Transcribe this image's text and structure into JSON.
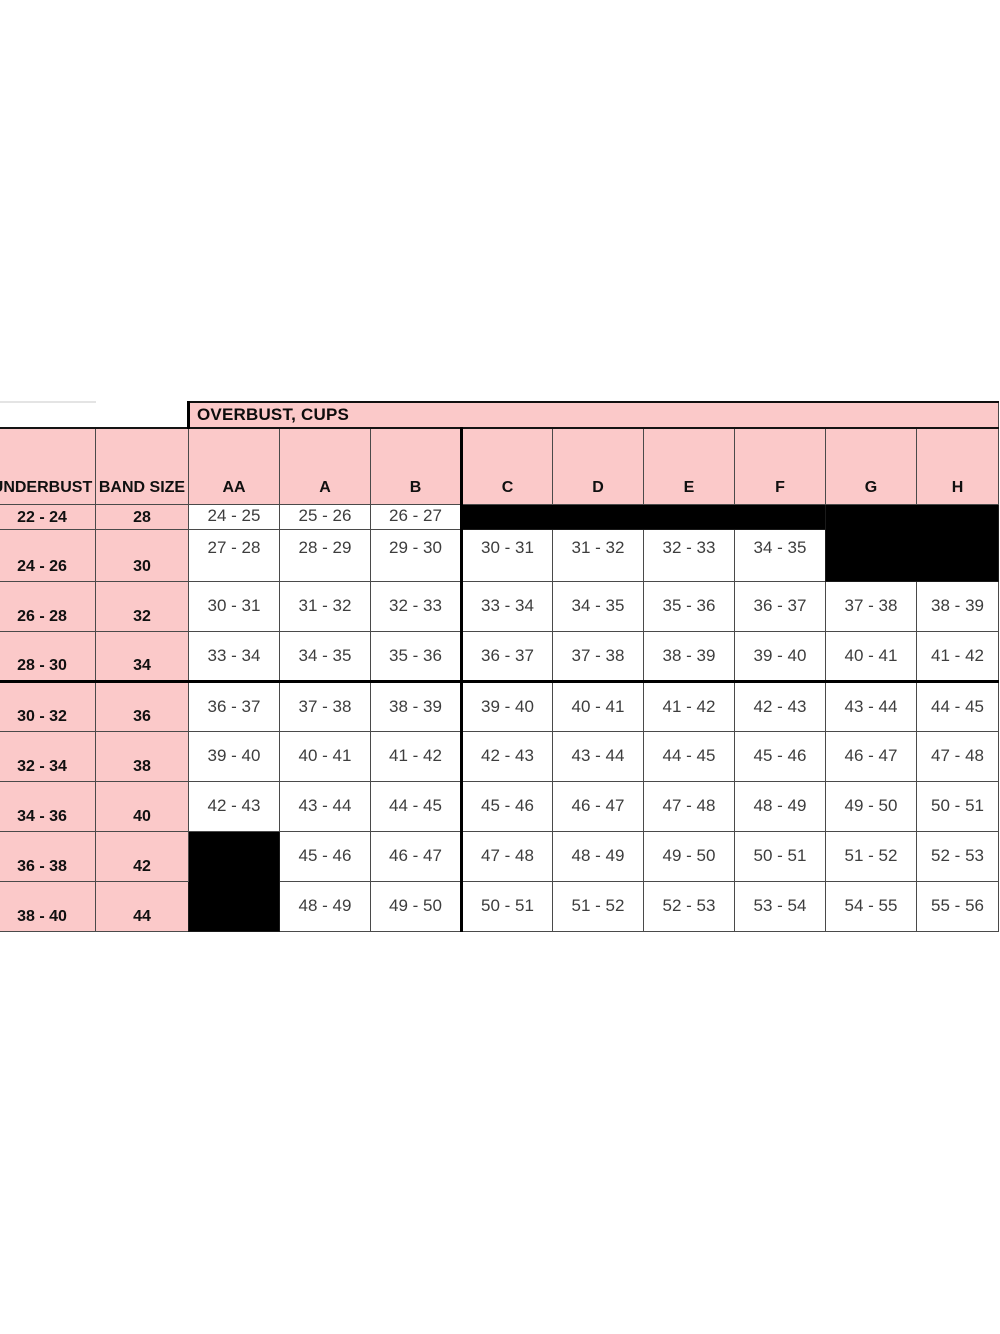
{
  "colors": {
    "header_pink": "#fbc9c9",
    "blackout_cell": "#000000",
    "grid_line": "#4a4a4a",
    "data_text": "#3d3d3d",
    "header_text": "#101010"
  },
  "table": {
    "overbust_title": "OVERBUST, CUPS",
    "col_headers": [
      "UNDERBUST",
      "BAND SIZE",
      "AA",
      "A",
      "B",
      "C",
      "D",
      "E",
      "F",
      "G",
      "H"
    ],
    "render_rows": [
      {
        "underbust": "22 - 24",
        "band": "28",
        "cells": [
          "24 - 25",
          "25 - 26",
          "26 - 27",
          {
            "black": true,
            "colspan": 4
          },
          {
            "black": true,
            "colspan": 2,
            "rowspan": 2
          }
        ]
      },
      {
        "underbust": "24 - 26",
        "band": "30",
        "cells": [
          "27 - 28",
          "28 - 29",
          "29 - 30",
          "30 - 31",
          "31 - 32",
          "32 - 33",
          "34 - 35"
        ]
      },
      {
        "underbust": "26 - 28",
        "band": "32",
        "cells": [
          "30 - 31",
          "31 - 32",
          "32 - 33",
          "33 - 34",
          "34 - 35",
          "35 - 36",
          "36 - 37",
          "37 - 38",
          "38 - 39"
        ]
      },
      {
        "underbust": "28 - 30",
        "band": "34",
        "cells": [
          "33 - 34",
          "34 - 35",
          "35 - 36",
          "36 - 37",
          "37 - 38",
          "38 - 39",
          "39 - 40",
          "40 - 41",
          "41 - 42"
        ]
      },
      {
        "underbust": "30 - 32",
        "band": "36",
        "cells": [
          "36 - 37",
          "37 - 38",
          "38 - 39",
          "39 - 40",
          "40 - 41",
          "41 - 42",
          "42 - 43",
          "43 - 44",
          "44 - 45"
        ]
      },
      {
        "underbust": "32 - 34",
        "band": "38",
        "cells": [
          "39 - 40",
          "40 - 41",
          "41 - 42",
          "42 - 43",
          "43 - 44",
          "44 - 45",
          "45 - 46",
          "46 - 47",
          "47 - 48"
        ]
      },
      {
        "underbust": "34 - 36",
        "band": "40",
        "cells": [
          "42 - 43",
          "43 - 44",
          "44 - 45",
          "45 - 46",
          "46 - 47",
          "47 - 48",
          "48 - 49",
          "49 - 50",
          "50 - 51"
        ]
      },
      {
        "underbust": "36 - 38",
        "band": "42",
        "cells": [
          {
            "black": true,
            "rowspan": 2
          },
          "45 - 46",
          "46 - 47",
          "47 - 48",
          "48 - 49",
          "49 - 50",
          "50 - 51",
          "51 - 52",
          "52 - 53"
        ]
      },
      {
        "underbust": "38 - 40",
        "band": "44",
        "cells": [
          "48 - 49",
          "49 - 50",
          "50 - 51",
          "51 - 52",
          "52 - 53",
          "53 - 54",
          "54 - 55",
          "55 - 56"
        ]
      }
    ]
  },
  "chart_data": {
    "type": "table",
    "title": "OVERBUST, CUPS",
    "columns": [
      "UNDERBUST",
      "BAND SIZE",
      "AA",
      "A",
      "B",
      "C",
      "D",
      "E",
      "F",
      "G",
      "H"
    ],
    "rows": [
      [
        "22 - 24",
        "28",
        "24 - 25",
        "25 - 26",
        "26 - 27",
        null,
        null,
        null,
        null,
        null,
        null
      ],
      [
        "24 - 26",
        "30",
        "27 - 28",
        "28 - 29",
        "29 - 30",
        "30 - 31",
        "31 - 32",
        "32 - 33",
        "34 - 35",
        null,
        null
      ],
      [
        "26 - 28",
        "32",
        "30 - 31",
        "31 - 32",
        "32 - 33",
        "33 - 34",
        "34 - 35",
        "35 - 36",
        "36 - 37",
        "37 - 38",
        "38 - 39"
      ],
      [
        "28 - 30",
        "34",
        "33 - 34",
        "34 - 35",
        "35 - 36",
        "36 - 37",
        "37 - 38",
        "38 - 39",
        "39 - 40",
        "40 - 41",
        "41 - 42"
      ],
      [
        "30 - 32",
        "36",
        "36 - 37",
        "37 - 38",
        "38 - 39",
        "39 - 40",
        "40 - 41",
        "41 - 42",
        "42 - 43",
        "43 - 44",
        "44 - 45"
      ],
      [
        "32 - 34",
        "38",
        "39 - 40",
        "40 - 41",
        "41 - 42",
        "42 - 43",
        "43 - 44",
        "44 - 45",
        "45 - 46",
        "46 - 47",
        "47 - 48"
      ],
      [
        "34 - 36",
        "40",
        "42 - 43",
        "43 - 44",
        "44 - 45",
        "45 - 46",
        "46 - 47",
        "47 - 48",
        "48 - 49",
        "49 - 50",
        "50 - 51"
      ],
      [
        "36 - 38",
        "42",
        null,
        "45 - 46",
        "46 - 47",
        "47 - 48",
        "48 - 49",
        "49 - 50",
        "50 - 51",
        "51 - 52",
        "52 - 53"
      ],
      [
        "38 - 40",
        "44",
        null,
        "48 - 49",
        "49 - 50",
        "50 - 51",
        "51 - 52",
        "52 - 53",
        "53 - 54",
        "54 - 55",
        "55 - 56"
      ]
    ]
  }
}
